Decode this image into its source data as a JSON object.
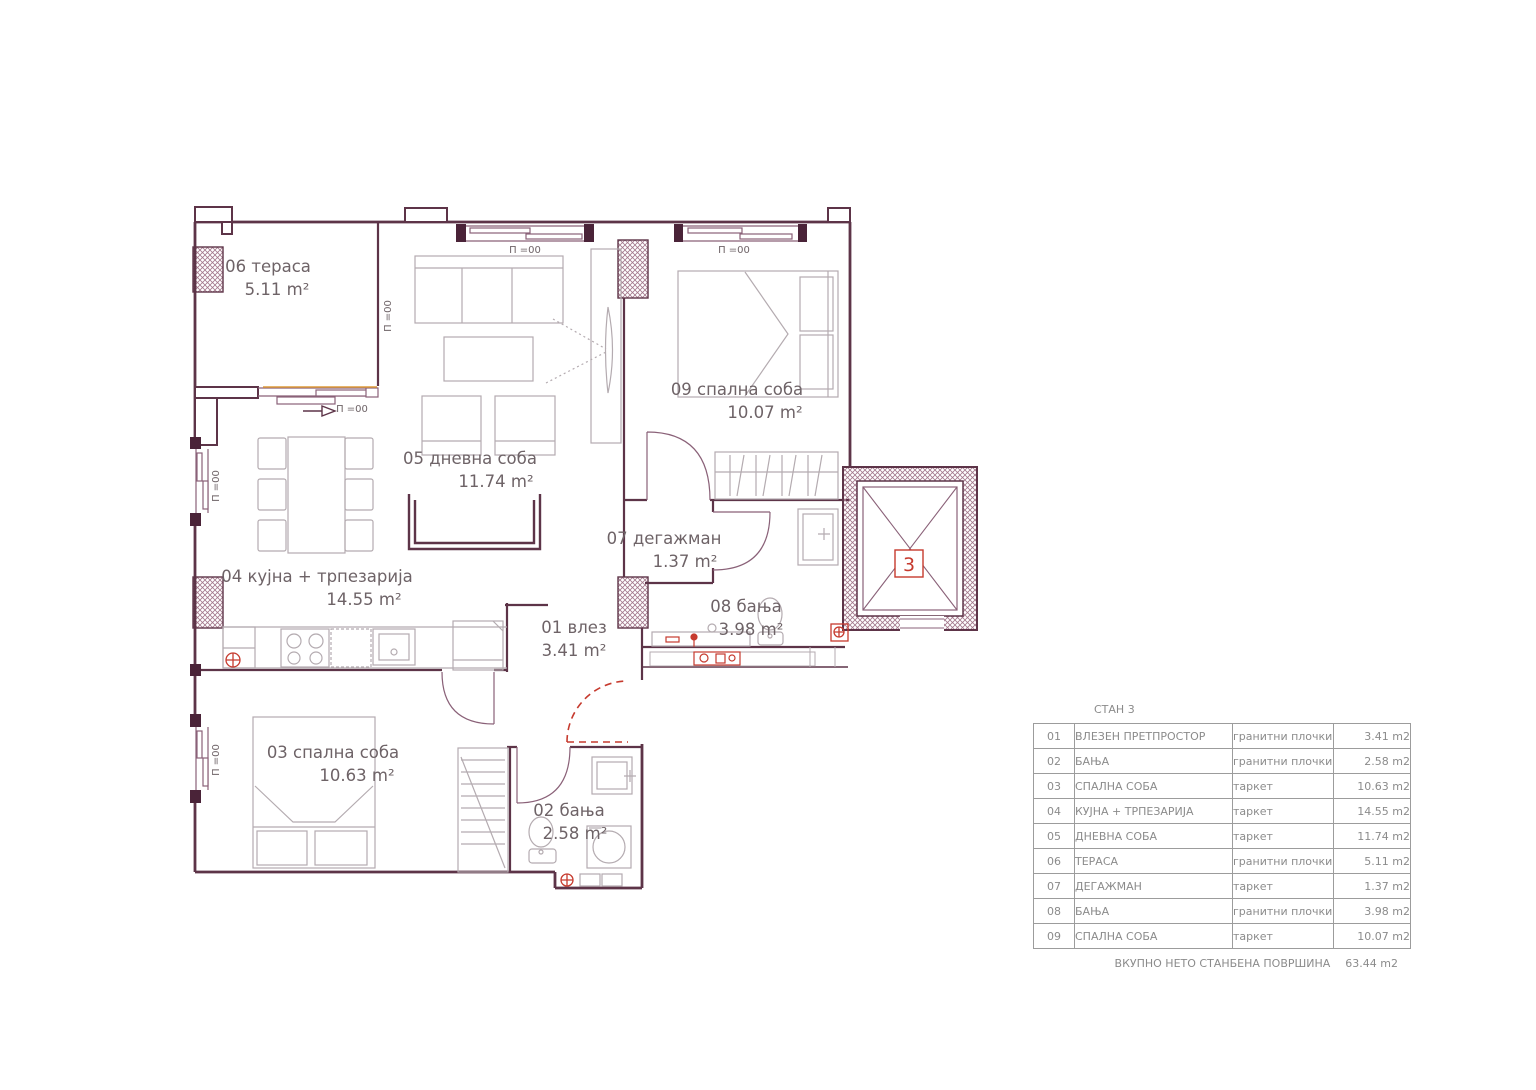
{
  "plan": {
    "level_marker": "П =00",
    "elevator_number": "3",
    "rooms": [
      {
        "label": "01 влез",
        "area": "3.41 m²"
      },
      {
        "label": "02 бања",
        "area": "2.58 m²"
      },
      {
        "label": "03 спална соба",
        "area": "10.63 m²"
      },
      {
        "label": "04 кујна + трпезарија",
        "area": "14.55 m²"
      },
      {
        "label": "05 дневна соба",
        "area": "11.74 m²"
      },
      {
        "label": "06 тераса",
        "area": "5.11 m²"
      },
      {
        "label": "07 дегажман",
        "area": "1.37 m²"
      },
      {
        "label": "08 бања",
        "area": "3.98 m²"
      },
      {
        "label": "09 спална соба",
        "area": "10.07 m²"
      }
    ],
    "colors": {
      "wall": "#5d3448",
      "wall_dark": "#4a2338",
      "window_frame": "#8a6178",
      "furniture": "#b4abb0",
      "red_accent": "#c63a2e",
      "orange_accent": "#dd9b3a",
      "label_text": "#6e6367"
    }
  },
  "table": {
    "title": "СТАН 3",
    "rows": [
      {
        "num": "01",
        "name": "ВЛЕЗЕН ПРЕТПРОСТОР",
        "floor": "гранитни плочки",
        "area": "3.41 m2"
      },
      {
        "num": "02",
        "name": "БАЊА",
        "floor": "гранитни плочки",
        "area": "2.58 m2"
      },
      {
        "num": "03",
        "name": "СПАЛНА СОБА",
        "floor": "таркет",
        "area": "10.63 m2"
      },
      {
        "num": "04",
        "name": "КУЈНА + ТРПЕЗАРИЈА",
        "floor": "таркет",
        "area": "14.55 m2"
      },
      {
        "num": "05",
        "name": "ДНЕВНА СОБА",
        "floor": "таркет",
        "area": "11.74 m2"
      },
      {
        "num": "06",
        "name": "ТЕРАСА",
        "floor": "гранитни плочки",
        "area": "5.11 m2"
      },
      {
        "num": "07",
        "name": "ДЕГАЖМАН",
        "floor": "таркет",
        "area": "1.37 m2"
      },
      {
        "num": "08",
        "name": "БАЊА",
        "floor": "гранитни плочки",
        "area": "3.98 m2"
      },
      {
        "num": "09",
        "name": "СПАЛНА СОБА",
        "floor": "таркет",
        "area": "10.07 m2"
      }
    ],
    "footer_label": "ВКУПНО НЕТО СТАНБЕНА ПОВРШИНА",
    "footer_value": "63.44 m2"
  }
}
